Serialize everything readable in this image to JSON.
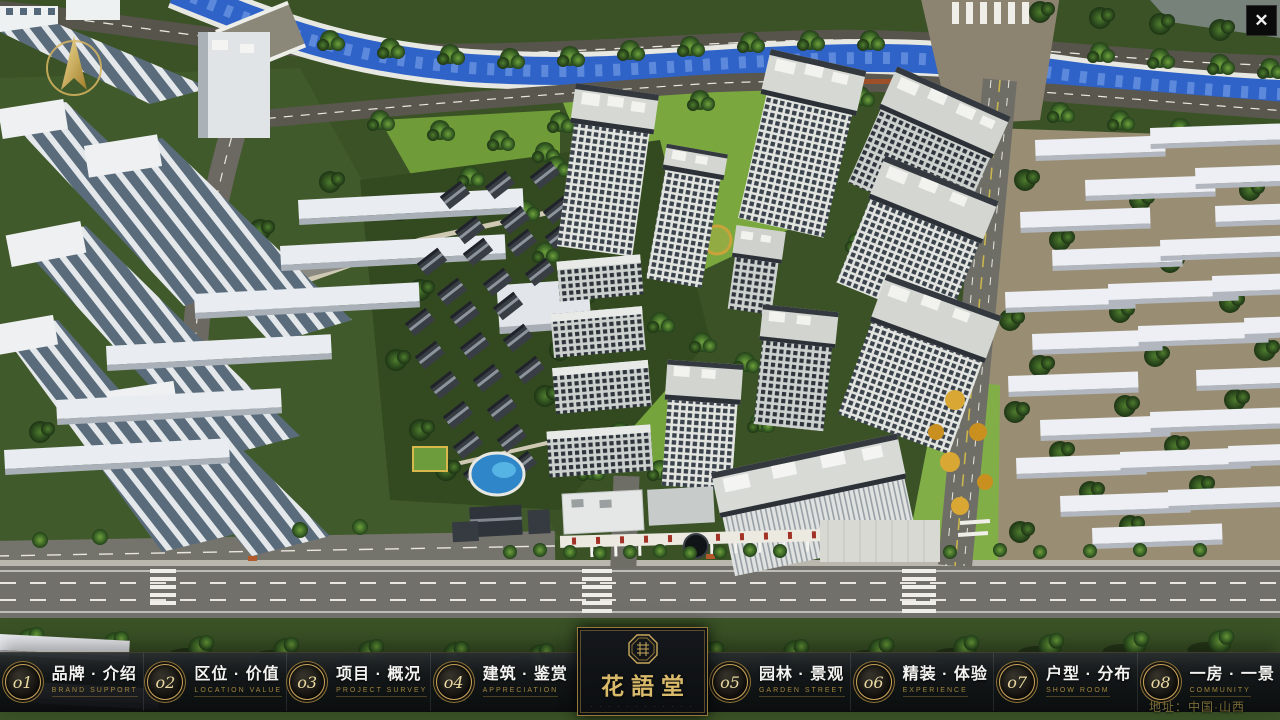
{
  "window": {
    "close_label": "✕"
  },
  "map": {
    "address_label": "地址：中国·山西",
    "scene_description": "residential-masterplan-aerial-render"
  },
  "logo": {
    "title": "花語堂",
    "subtitle": "· · · · · · · · · · · ·",
    "seal_icon": "octagon-seal"
  },
  "nav": {
    "items": [
      {
        "num": "o1",
        "zh": "品牌 · 介绍",
        "en": "BRAND SUPPORT"
      },
      {
        "num": "o2",
        "zh": "区位 · 价值",
        "en": "LOCATION VALUE"
      },
      {
        "num": "o3",
        "zh": "项目 · 概况",
        "en": "PROJECT SURVEY"
      },
      {
        "num": "o4",
        "zh": "建筑 · 鉴赏",
        "en": "APPRECIATION"
      },
      {
        "num": "o5",
        "zh": "园林 · 景观",
        "en": "GARDEN STREET"
      },
      {
        "num": "o6",
        "zh": "精装 · 体验",
        "en": "EXPERIENCE"
      },
      {
        "num": "o7",
        "zh": "户型 · 分布",
        "en": "SHOW ROOM"
      },
      {
        "num": "o8",
        "zh": "一房 · 一景",
        "en": "COMMUNITY"
      }
    ]
  },
  "colors": {
    "gold_accent": "#c9a95c",
    "nav_background": "#101418",
    "river_blue": "#2f63c8",
    "lawn_green": "#7aa83e"
  }
}
